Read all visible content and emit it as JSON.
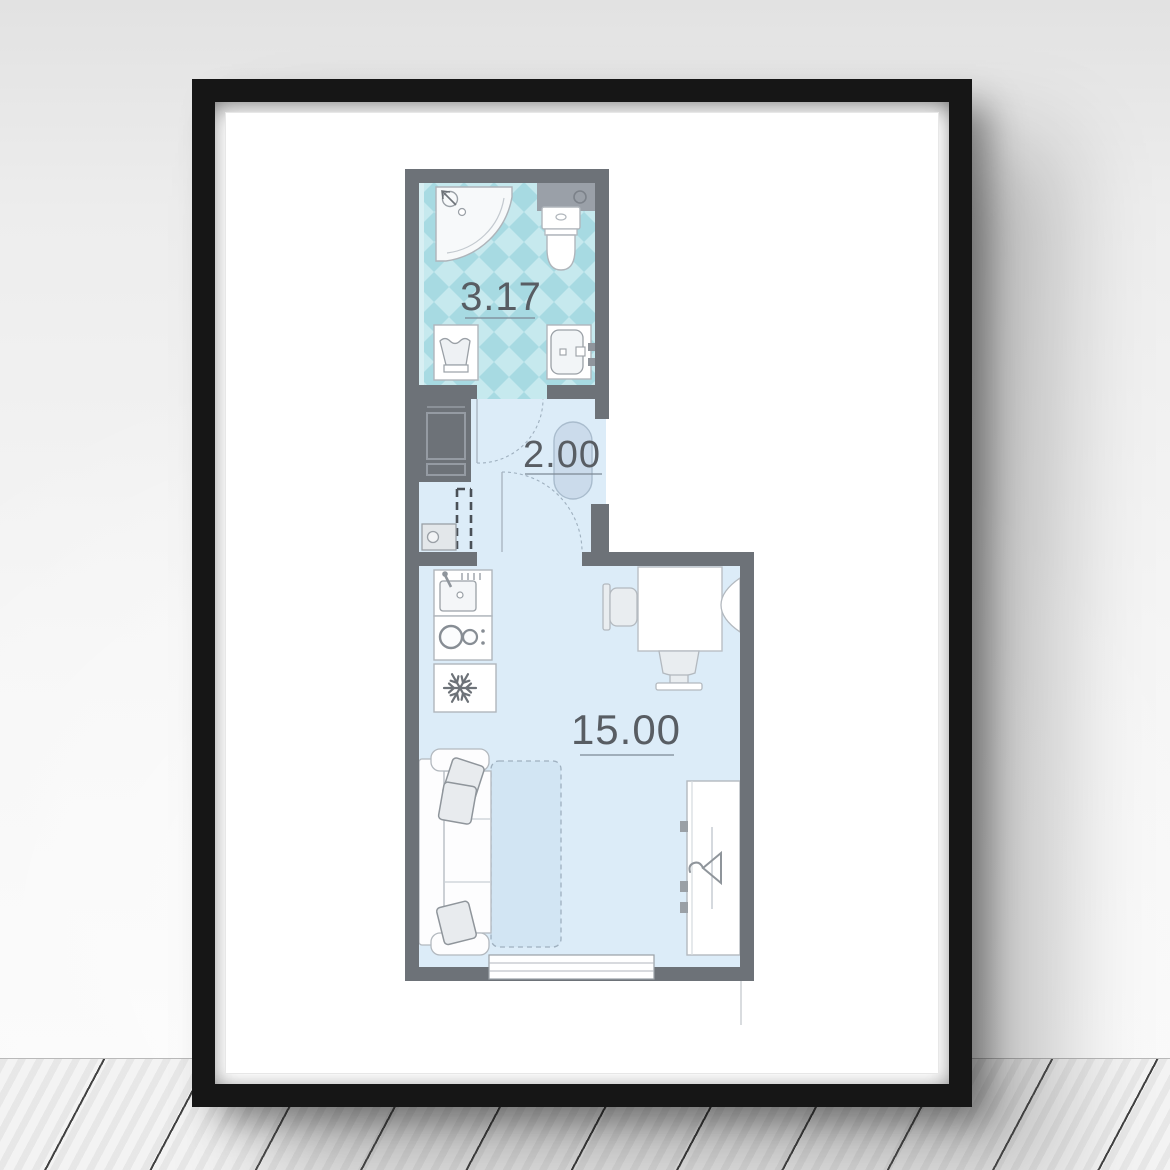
{
  "artwork": {
    "title": "studio-apartment-floor-plan-poster",
    "rooms": [
      {
        "name": "bathroom",
        "area": "3.17"
      },
      {
        "name": "hallway",
        "area": "2.00"
      },
      {
        "name": "living-room",
        "area": "15.00"
      }
    ],
    "fixtures": [
      "shower-icon",
      "toilet-icon",
      "laundry-basket-icon",
      "bathroom-sink-icon",
      "hall-cabinet-icon",
      "sliding-door-dashes",
      "floor-drain-icon",
      "hall-rug-icon",
      "door-arc",
      "kitchen-sink-icon",
      "stove-icon",
      "fridge-snowflake-icon",
      "desk",
      "office-chair",
      "radiator-icon",
      "sofa",
      "pillow",
      "fold-out-bed",
      "wardrobe",
      "hanger-icon",
      "window"
    ],
    "colors": {
      "frame": "#161616",
      "mat": "#ffffff",
      "wall_gray": "#6d7278",
      "tile_teal": "#a7dae2",
      "tile_teal_light": "#c6e9ee",
      "floor_blue": "#dcecf8",
      "bed_extension_blue": "#d2e5f3",
      "label_text": "#585d63"
    }
  }
}
